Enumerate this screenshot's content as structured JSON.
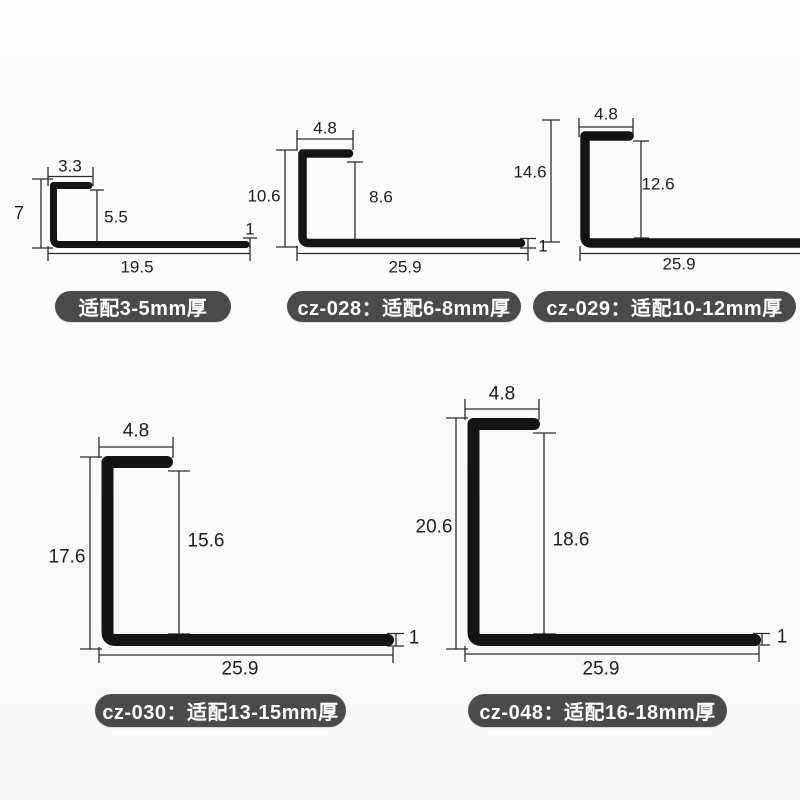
{
  "colors": {
    "background": "#fbfbfb",
    "profile_shape": "#141414",
    "dimension_line": "#2c2c2c",
    "dimension_text": "#1d1d1d",
    "badge_background": "#4a4a4a",
    "badge_text": "#ffffff"
  },
  "profiles": [
    {
      "badge": "适配3-5mm厚",
      "dims": {
        "top_width": "3.3",
        "outer_height": "7",
        "inner_height": "5.5",
        "bottom_width": "19.5",
        "thickness": "1"
      }
    },
    {
      "badge": "cz-028：适配6-8mm厚",
      "dims": {
        "top_width": "4.8",
        "outer_height": "10.6",
        "inner_height": "8.6",
        "bottom_width": "25.9",
        "thickness": "1"
      }
    },
    {
      "badge": "cz-029：适配10-12mm厚",
      "dims": {
        "top_width": "4.8",
        "outer_height": "14.6",
        "inner_height": "12.6",
        "bottom_width": "25.9"
      }
    },
    {
      "badge": "cz-030：适配13-15mm厚",
      "dims": {
        "top_width": "4.8",
        "outer_height": "17.6",
        "inner_height": "15.6",
        "bottom_width": "25.9",
        "thickness": "1"
      }
    },
    {
      "badge": "cz-048：适配16-18mm厚",
      "dims": {
        "top_width": "4.8",
        "outer_height": "20.6",
        "inner_height": "18.6",
        "bottom_width": "25.9",
        "thickness": "1"
      }
    }
  ]
}
